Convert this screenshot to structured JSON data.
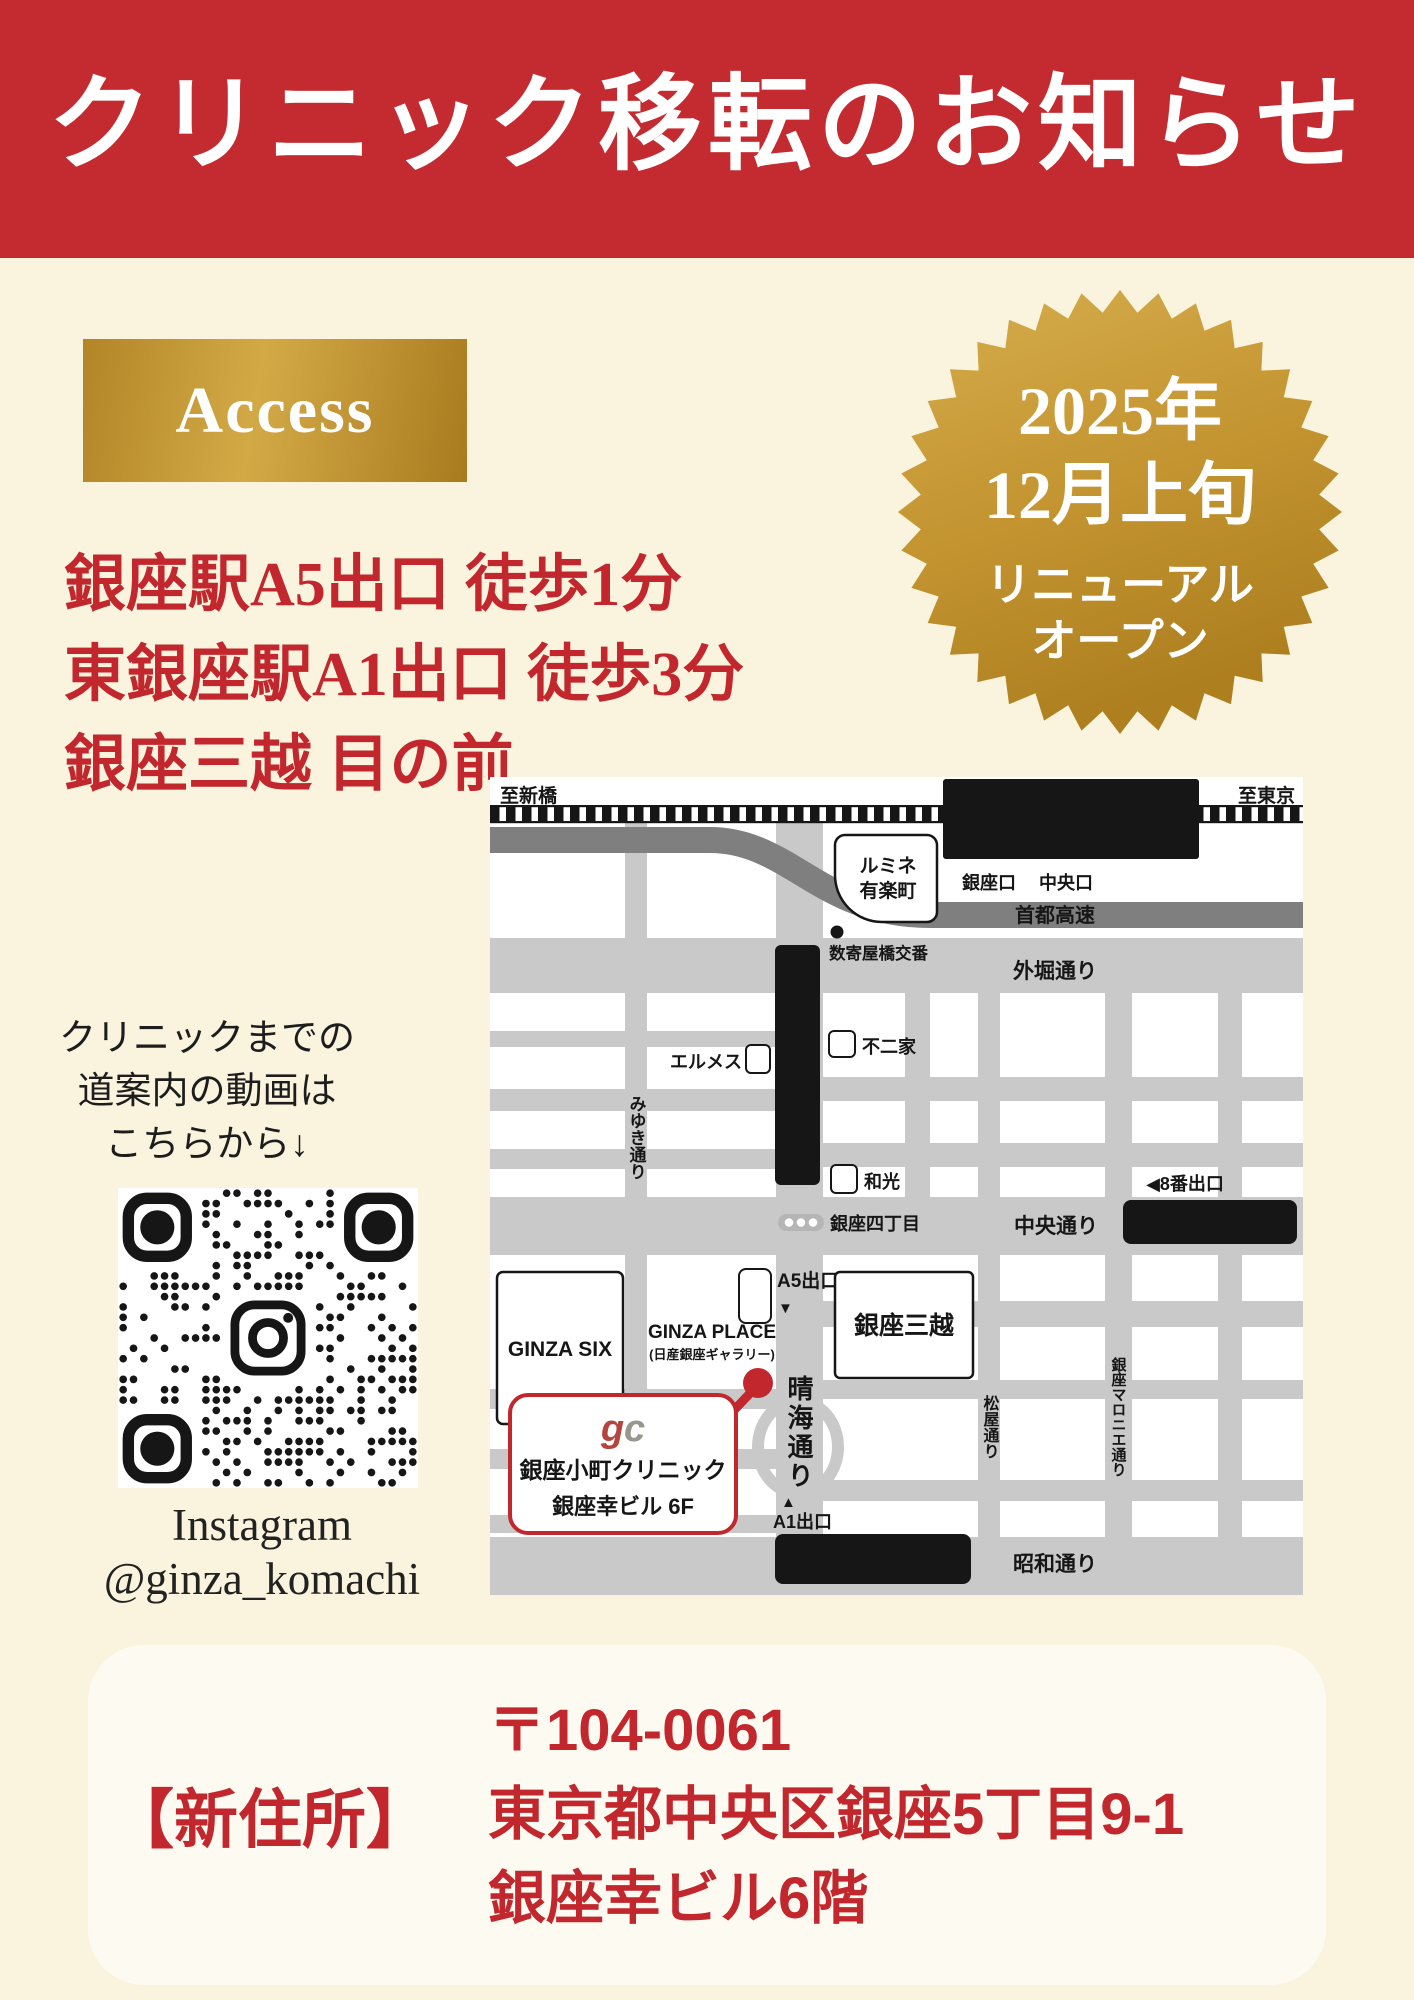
{
  "colors": {
    "header_red": "#c42b30",
    "accent_red": "#c1272d",
    "cream_bg": "#faf3de",
    "gold_light": "#d3a946",
    "gold_dark": "#a87c1e",
    "address_box_bg": "#fdfaf1",
    "road_gray": "#c9c9c9",
    "highway_gray": "#7f7f7f",
    "map_black": "#161616"
  },
  "header": {
    "title": "クリニック移転のお知らせ"
  },
  "access": {
    "badge": "Access",
    "lines": [
      "銀座駅A5出口 徒歩1分",
      "東銀座駅A1出口 徒歩3分",
      "銀座三越 目の前"
    ]
  },
  "seal": {
    "lines": [
      "2025年",
      "12月上旬",
      "リニューアル",
      "オープン"
    ]
  },
  "guide": {
    "lines": [
      "クリニックまでの",
      "道案内の動画は",
      "こちらから↓"
    ]
  },
  "qr": {
    "caption_line1": "Instagram",
    "caption_line2": "@ginza_komachi"
  },
  "address": {
    "label": "【新住所】",
    "lines": [
      "〒104-0061",
      "東京都中央区銀座5丁目9-1",
      "銀座幸ビル6階"
    ]
  },
  "map": {
    "labels": {
      "to_shimbashi": "至新橋",
      "to_tokyo": "至東京",
      "yurakucho_station": "有楽町駅",
      "ginza_exit": "銀座口",
      "chuo_exit": "中央口",
      "lumine_line1": "ルミネ",
      "lumine_line2": "有楽町",
      "shuto_expressway": "首都高速",
      "sukiyabashi_koban": "数寄屋橋交番",
      "sotobori_dori": "外堀通り",
      "fujiya": "不二家",
      "hermes": "エルメス",
      "ginza_station": "銀座駅",
      "wako": "和光",
      "miyuki_dori": "みゆき通り",
      "ginza_4chome": "銀座四丁目",
      "chuo_dori": "中央通り",
      "exit8": "◀8番出口",
      "ginza_itchome_station": "銀座一丁目駅",
      "a5_exit": "A5出口",
      "a5_arrow": "▼",
      "ginza_place_line1": "GINZA PLACE",
      "ginza_place_line2": "(日産銀座ギャラリー)",
      "ginza_six": "GINZA SIX",
      "ginza_mitsukoshi": "銀座三越",
      "harumi_dori": "晴海通り",
      "matsuya_dori": "松屋通り",
      "marronnier_dori": "銀座マロニエ通り",
      "a1_exit": "A1出口",
      "a1_arrow": "▲",
      "higashi_ginza_station": "東銀座駅",
      "showa_dori": "昭和通り"
    },
    "clinic": {
      "logo_g": "g",
      "logo_c": "c",
      "name": "銀座小町クリニック",
      "building": "銀座幸ビル 6F"
    }
  }
}
